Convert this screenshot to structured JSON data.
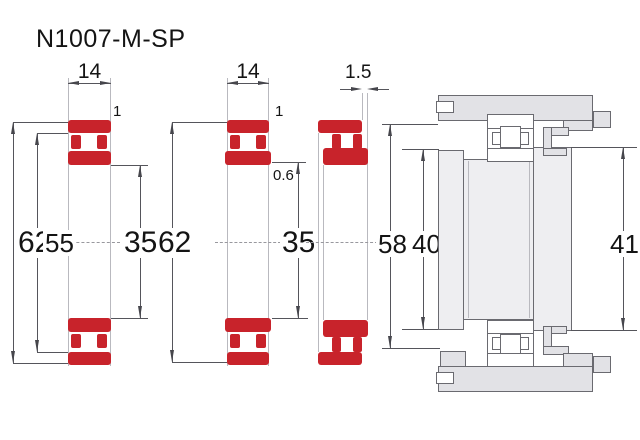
{
  "title": "N1007-M-SP",
  "accent_red": "#c8232b",
  "views": {
    "front_section": {
      "width": "14",
      "outer_diameter": "62",
      "rib_diameter": "55",
      "bore_diameter": "35",
      "chamfer": "1"
    },
    "middle_section": {
      "width": "14",
      "outer_diameter": "62",
      "bore_diameter": "35",
      "chamfer": "1",
      "inner_chamfer": "0.6"
    },
    "displaced_section": {
      "axial_offset": "1.5",
      "housing_shoulder_diameter": "58",
      "shaft_shoulder_diameter": "40"
    },
    "mounting": {
      "abutment_diameter": "41"
    }
  }
}
